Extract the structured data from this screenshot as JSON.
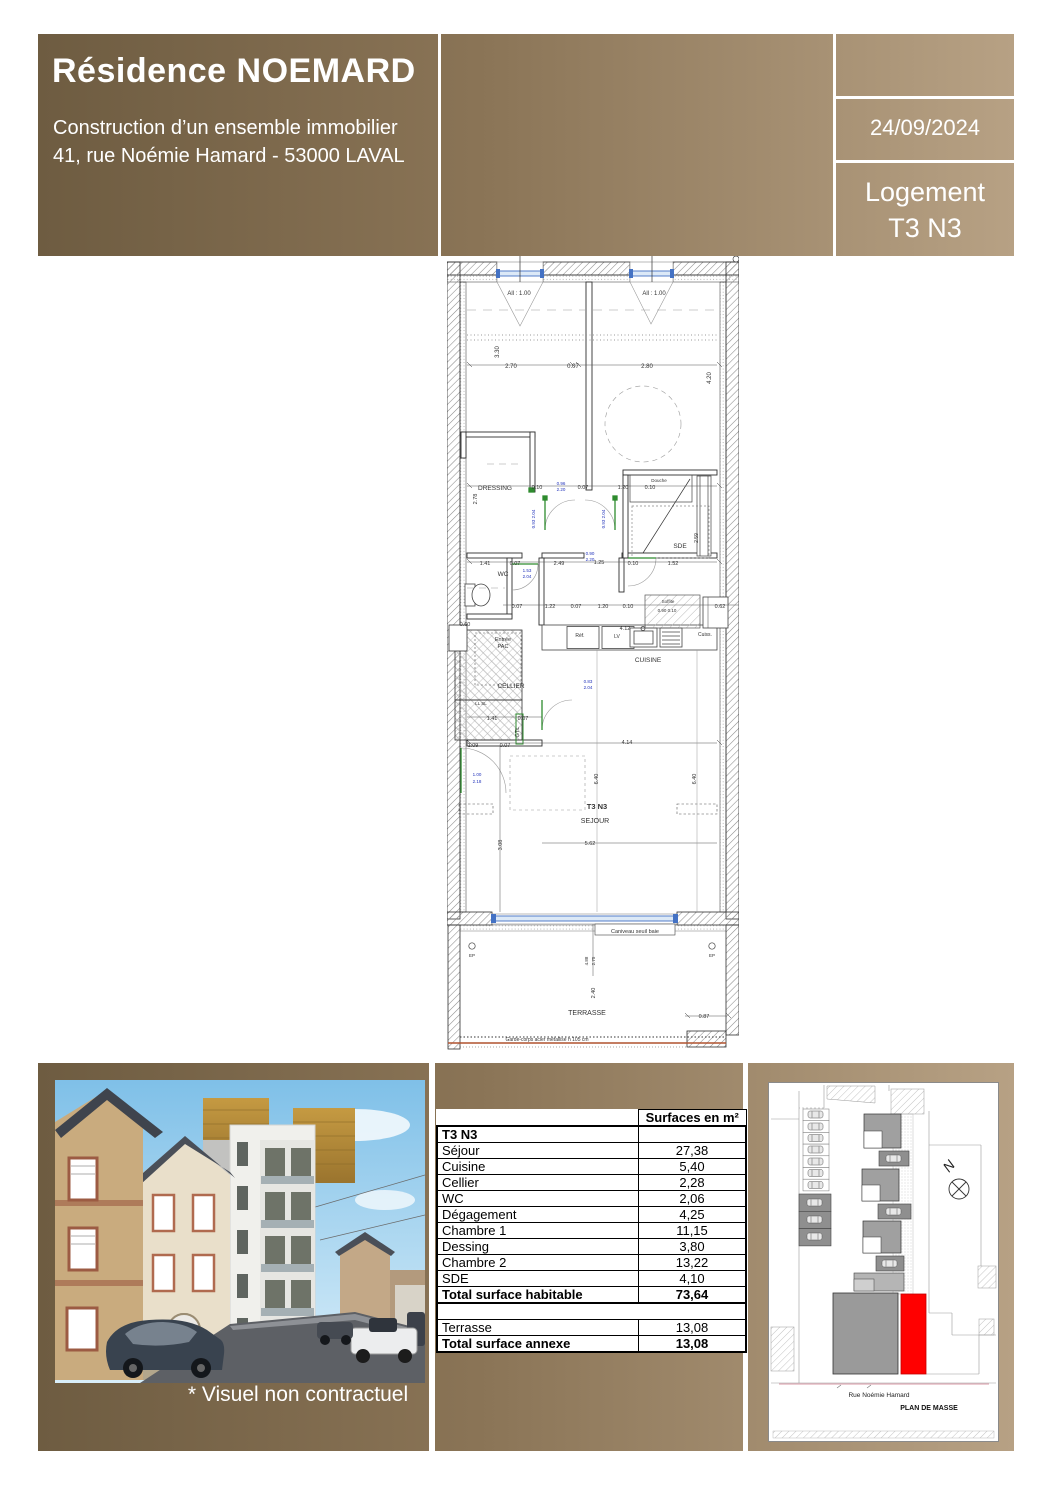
{
  "header": {
    "title": "Résidence NOEMARD",
    "subtitle_line1": "Construction d’un ensemble immobilier",
    "subtitle_line2": "41, rue Noémie Hamard - 53000 LAVAL",
    "date": "24/09/2024",
    "logement_line1": "Logement",
    "logement_line2": "T3 N3",
    "gradient_left": "#6e5c41",
    "gradient_right": "#b7a184"
  },
  "photo": {
    "caption": "* Visuel non contractuel"
  },
  "surface_table": {
    "col_header": "Surfaces en m²",
    "rows": [
      {
        "label": "T3 N3",
        "value": "",
        "bold": true
      },
      {
        "label": "Séjour",
        "value": "27,38"
      },
      {
        "label": "Cuisine",
        "value": "5,40"
      },
      {
        "label": "Cellier",
        "value": "2,28"
      },
      {
        "label": "WC",
        "value": "2,06"
      },
      {
        "label": "Dégagement",
        "value": "4,25"
      },
      {
        "label": "Chambre 1",
        "value": "11,15"
      },
      {
        "label": "Dessing",
        "value": "3,80"
      },
      {
        "label": "Chambre 2",
        "value": "13,22"
      },
      {
        "label": "SDE",
        "value": "4,10"
      },
      {
        "label": "Total surface habitable",
        "value": "73,64",
        "bold": true,
        "thick": true
      },
      {
        "spacer": true
      },
      {
        "label": "Terrasse",
        "value": "13,08"
      },
      {
        "label": "Total surface annexe",
        "value": "13,08",
        "bold": true
      }
    ]
  },
  "site_plan": {
    "street": "Rue Noémie Hamard",
    "title": "PLAN DE MASSE",
    "north_label": "N",
    "highlight_color": "#ff0000"
  },
  "floor_plan": {
    "labels": [
      {
        "t": "All : 1.00",
        "x": 72,
        "y": 39,
        "s": 6
      },
      {
        "t": "All : 1.00",
        "x": 207,
        "y": 39,
        "s": 6
      },
      {
        "t": "2.70",
        "x": 64,
        "y": 112,
        "s": 6
      },
      {
        "t": "0.07",
        "x": 126,
        "y": 112,
        "s": 6
      },
      {
        "t": "2.80",
        "x": 200,
        "y": 112,
        "s": 6
      },
      {
        "t": "3.30",
        "x": 52,
        "y": 96,
        "s": 6,
        "r": -90
      },
      {
        "t": "4.20",
        "x": 264,
        "y": 122,
        "s": 6,
        "r": -90
      },
      {
        "t": "DRESSING",
        "x": 48,
        "y": 234,
        "s": 6.5
      },
      {
        "t": "0.10",
        "x": 90,
        "y": 233,
        "s": 5.5
      },
      {
        "t": "0.96",
        "x": 114,
        "y": 229,
        "s": 4.5,
        "c": "#2233bb"
      },
      {
        "t": "2.20",
        "x": 114,
        "y": 235,
        "s": 4.5,
        "c": "#2233bb"
      },
      {
        "t": "0.07",
        "x": 136,
        "y": 233,
        "s": 5.5
      },
      {
        "t": "1.20",
        "x": 176,
        "y": 233,
        "s": 5.5
      },
      {
        "t": "0.10",
        "x": 203,
        "y": 233,
        "s": 5.5
      },
      {
        "t": "2.78",
        "x": 30,
        "y": 243,
        "s": 5.5,
        "r": -90
      },
      {
        "t": "Douche",
        "x": 212,
        "y": 226,
        "s": 4.5
      },
      {
        "t": "SDE",
        "x": 233,
        "y": 292,
        "s": 6.5
      },
      {
        "t": "2.59",
        "x": 251,
        "y": 282,
        "s": 5,
        "r": -90
      },
      {
        "t": "0.93 2.04",
        "x": 88,
        "y": 263,
        "s": 4.5,
        "c": "#2233bb",
        "r": -90
      },
      {
        "t": "0.93 2.04",
        "x": 158,
        "y": 263,
        "s": 4.5,
        "c": "#2233bb",
        "r": -90
      },
      {
        "t": "WC",
        "x": 56,
        "y": 320,
        "s": 6.5
      },
      {
        "t": "1.41",
        "x": 38,
        "y": 309,
        "s": 5.5
      },
      {
        "t": "0.07",
        "x": 68,
        "y": 309,
        "s": 5.5
      },
      {
        "t": "2.49",
        "x": 112,
        "y": 309,
        "s": 5.5
      },
      {
        "t": "1.25",
        "x": 152,
        "y": 308,
        "s": 5.5
      },
      {
        "t": "0.10",
        "x": 186,
        "y": 309,
        "s": 5.5
      },
      {
        "t": "1.52",
        "x": 226,
        "y": 309,
        "s": 5.5
      },
      {
        "t": "0.90",
        "x": 143,
        "y": 299,
        "s": 4.5,
        "c": "#2233bb"
      },
      {
        "t": "2.20",
        "x": 143,
        "y": 305,
        "s": 4.5,
        "c": "#2233bb"
      },
      {
        "t": "1.53",
        "x": 80,
        "y": 316,
        "s": 4.5,
        "c": "#2233bb"
      },
      {
        "t": "2.04",
        "x": 80,
        "y": 322,
        "s": 4.5,
        "c": "#2233bb"
      },
      {
        "t": "0.07",
        "x": 70,
        "y": 352,
        "s": 5.5
      },
      {
        "t": "1.22",
        "x": 103,
        "y": 352,
        "s": 5.5
      },
      {
        "t": "0.07",
        "x": 129,
        "y": 352,
        "s": 5.5
      },
      {
        "t": "1.20",
        "x": 156,
        "y": 352,
        "s": 5.5
      },
      {
        "t": "0.10",
        "x": 181,
        "y": 352,
        "s": 5.5
      },
      {
        "t": "Soffite",
        "x": 221,
        "y": 347,
        "s": 4.5
      },
      {
        "t": "0.90  0.10",
        "x": 220,
        "y": 356,
        "s": 4.5
      },
      {
        "t": "0.62",
        "x": 273,
        "y": 352,
        "s": 5.5
      },
      {
        "t": "0.60",
        "x": 18,
        "y": 370,
        "s": 5.5
      },
      {
        "t": "Entrée",
        "x": 56,
        "y": 385,
        "s": 5.5
      },
      {
        "t": "PAC",
        "x": 56,
        "y": 392,
        "s": 5.5
      },
      {
        "t": "CELLIER",
        "x": 64,
        "y": 432,
        "s": 6.5
      },
      {
        "t": "Réf.",
        "x": 133,
        "y": 381,
        "s": 5
      },
      {
        "t": "LV",
        "x": 170,
        "y": 382,
        "s": 5
      },
      {
        "t": "4.12",
        "x": 178,
        "y": 374,
        "s": 5.5
      },
      {
        "t": "Cuiss.",
        "x": 258,
        "y": 380,
        "s": 5
      },
      {
        "t": "CUISINE",
        "x": 201,
        "y": 406,
        "s": 6.5
      },
      {
        "t": "LL SL",
        "x": 34,
        "y": 449,
        "s": 4.5
      },
      {
        "t": "1.41",
        "x": 45,
        "y": 464,
        "s": 5.5
      },
      {
        "t": "0.07",
        "x": 76,
        "y": 464,
        "s": 5.5
      },
      {
        "t": "GTL",
        "x": 72,
        "y": 476,
        "s": 5.5,
        "r": -90
      },
      {
        "t": "0.83",
        "x": 141,
        "y": 427,
        "s": 4.5,
        "c": "#2233bb"
      },
      {
        "t": "2.04",
        "x": 141,
        "y": 433,
        "s": 4.5,
        "c": "#2233bb"
      },
      {
        "t": "1.09",
        "x": 26,
        "y": 491,
        "s": 5.5
      },
      {
        "t": "0.07",
        "x": 58,
        "y": 491,
        "s": 5.5
      },
      {
        "t": "4.14",
        "x": 180,
        "y": 488,
        "s": 5.5
      },
      {
        "t": "1.00",
        "x": 30,
        "y": 520,
        "s": 4.5,
        "c": "#2233bb"
      },
      {
        "t": "2.18",
        "x": 30,
        "y": 527,
        "s": 4.5,
        "c": "#2233bb"
      },
      {
        "t": "6.40",
        "x": 151,
        "y": 523,
        "s": 5.5,
        "r": -90
      },
      {
        "t": "6.40",
        "x": 249,
        "y": 523,
        "s": 5.5,
        "r": -90
      },
      {
        "t": "T3 N3",
        "x": 150,
        "y": 553,
        "s": 7.5,
        "b": 1
      },
      {
        "t": "SEJOUR",
        "x": 148,
        "y": 567,
        "s": 7
      },
      {
        "t": "3.08",
        "x": 55,
        "y": 589,
        "s": 5.5,
        "r": -90
      },
      {
        "t": "5.62",
        "x": 143,
        "y": 589,
        "s": 5.5
      },
      {
        "t": "Caniveau seuil baie",
        "x": 188,
        "y": 677,
        "s": 5.5
      },
      {
        "t": "EP",
        "x": 25,
        "y": 701,
        "s": 4.5
      },
      {
        "t": "EP",
        "x": 265,
        "y": 701,
        "s": 4.5
      },
      {
        "t": "4.88",
        "x": 141,
        "y": 705,
        "s": 4.5,
        "r": -90
      },
      {
        "t": "2.75",
        "x": 148,
        "y": 705,
        "s": 4.5,
        "r": -90
      },
      {
        "t": "2.40",
        "x": 148,
        "y": 737,
        "s": 5.5,
        "r": -90
      },
      {
        "t": "TERRASSE",
        "x": 140,
        "y": 759,
        "s": 7
      },
      {
        "t": "0.87",
        "x": 257,
        "y": 762,
        "s": 5.5
      },
      {
        "t": "Garde-corps acier métallisé h 105 cm",
        "x": 100,
        "y": 785,
        "s": 5
      }
    ]
  }
}
